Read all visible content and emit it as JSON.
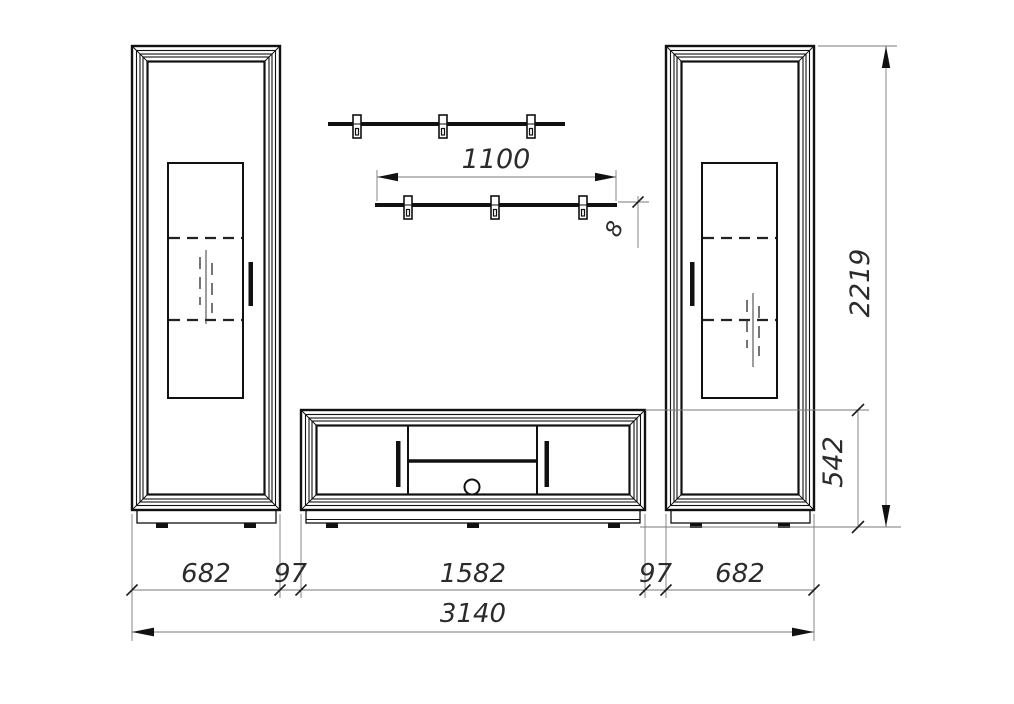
{
  "dimensions": {
    "shelf_length": "1100",
    "shelf_thickness": "8",
    "total_height": "2219",
    "tv_stand_height": "542",
    "left_cabinet_width": "682",
    "left_gap": "97",
    "tv_stand_width": "1582",
    "right_gap": "97",
    "right_cabinet_width": "682",
    "total_width": "3140"
  },
  "colors": {
    "outline": "#111111",
    "dimension_line": "#7a7a7a",
    "text": "#2b2b2b",
    "background": "#ffffff"
  }
}
